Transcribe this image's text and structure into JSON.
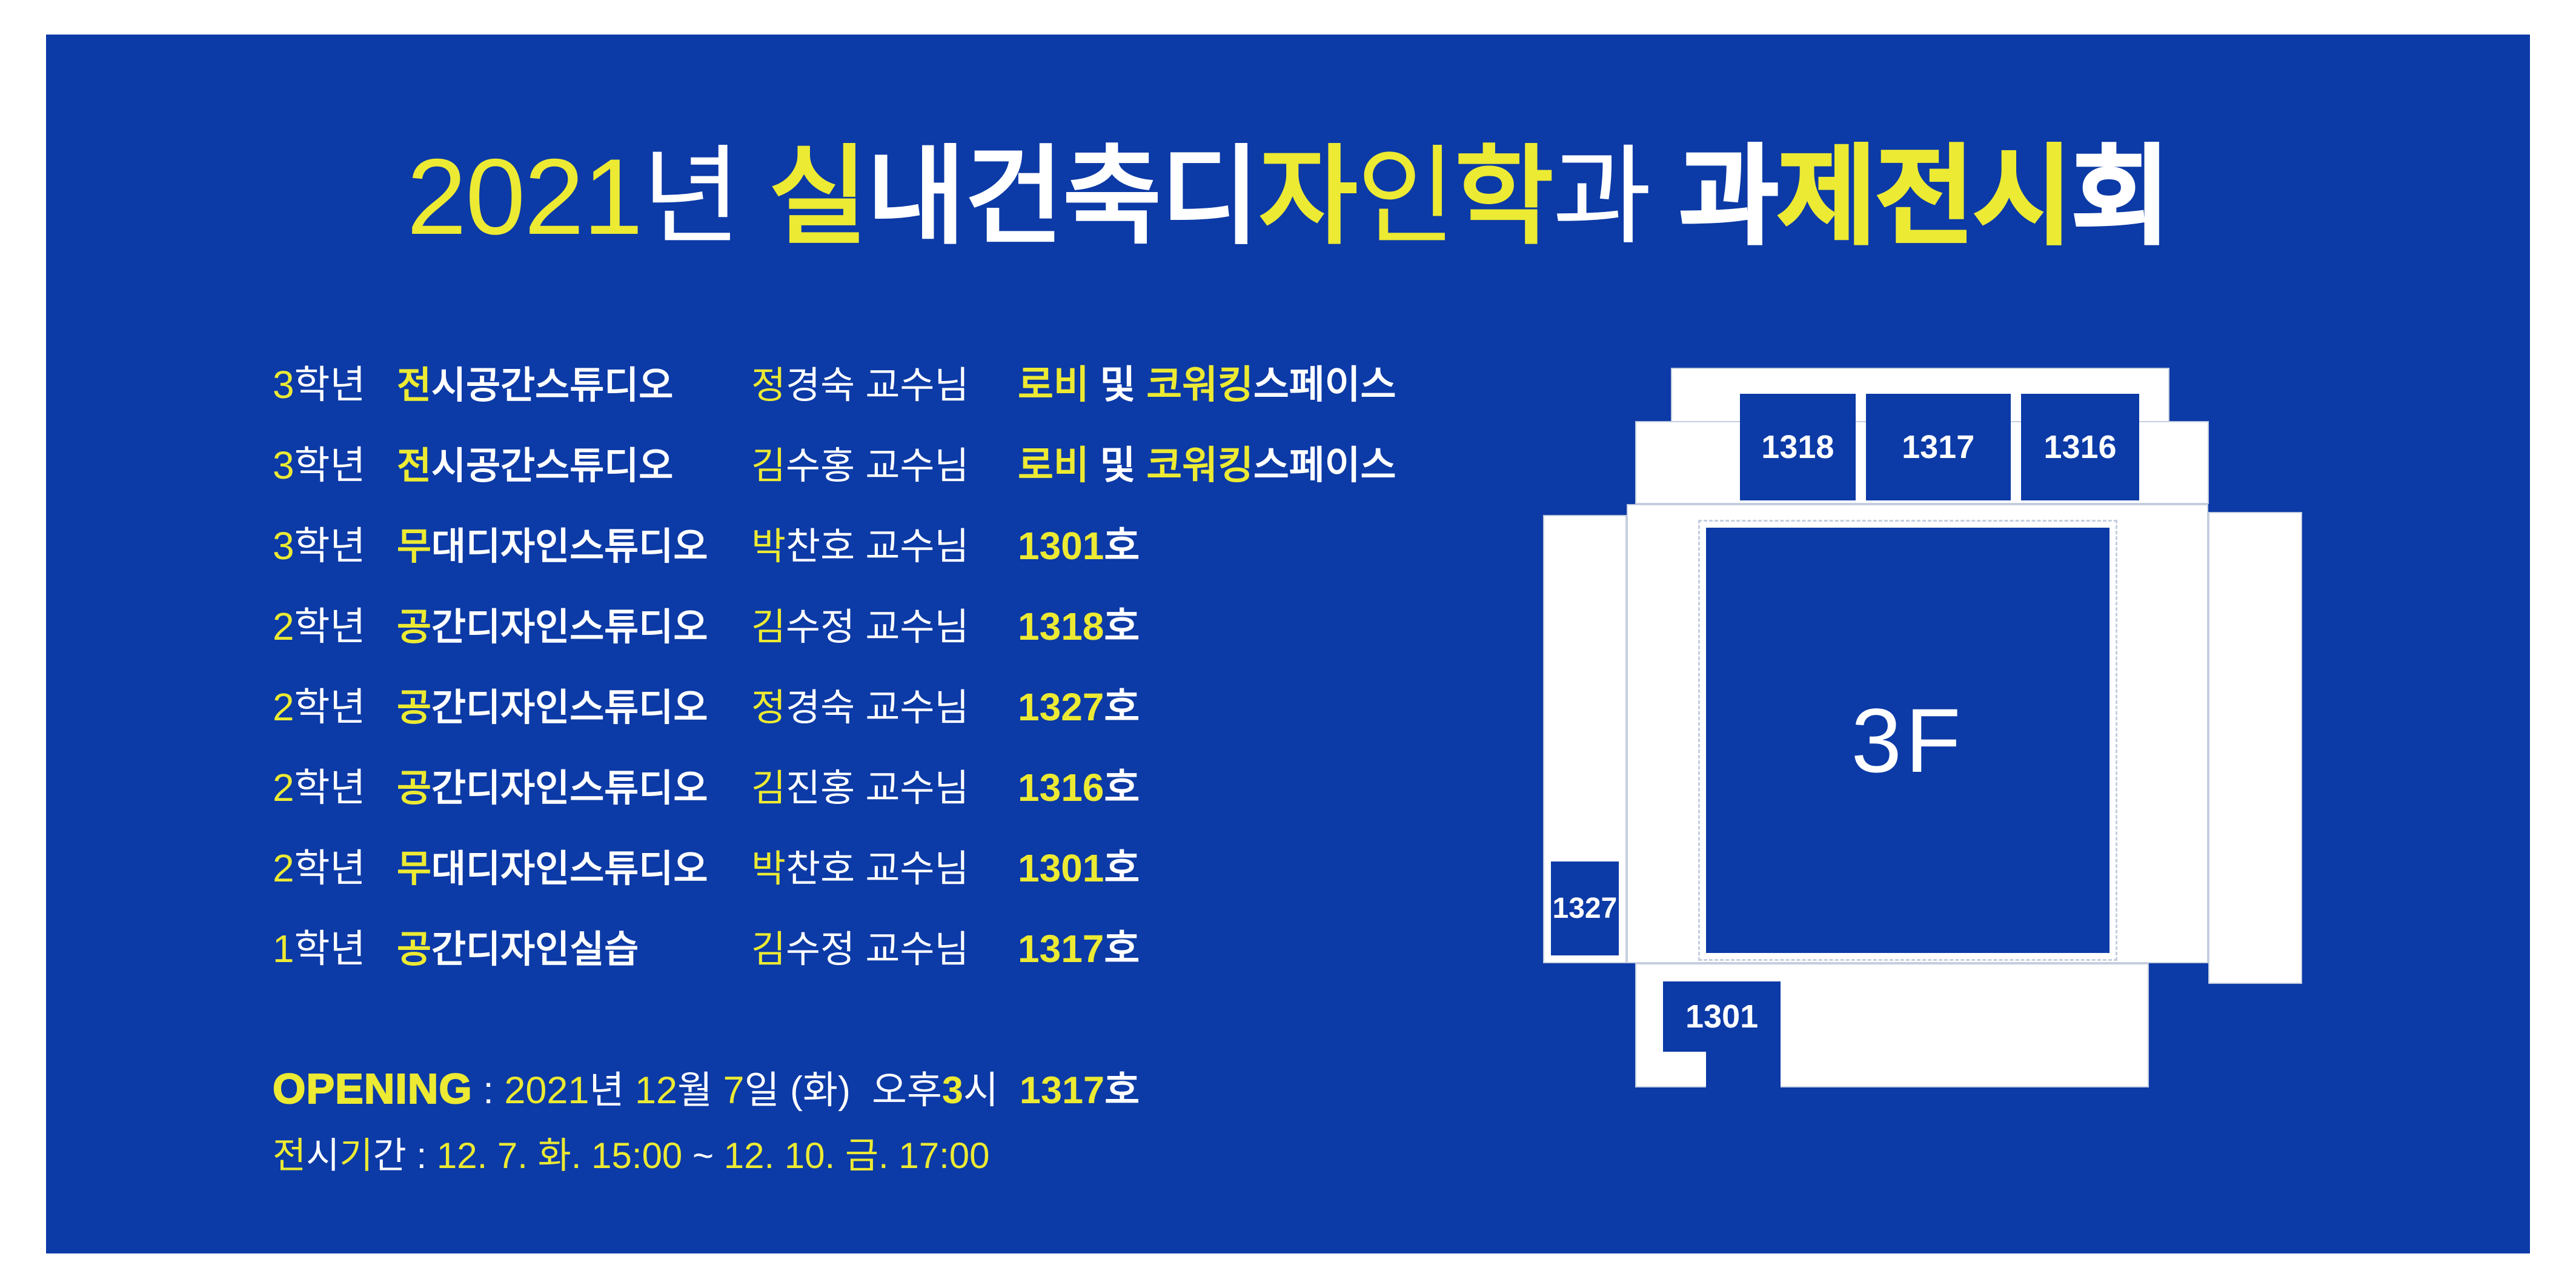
{
  "colors": {
    "background": "#0C3AA6",
    "accent": "#ECEA33",
    "white": "#FFFFFF",
    "plan_line": "#C5CEDF"
  },
  "title": {
    "segments": [
      {
        "t": "2021",
        "c": "y",
        "w": "l"
      },
      {
        "t": "년",
        "c": "w",
        "w": "l"
      },
      {
        "t": " ",
        "c": "w",
        "w": "l"
      },
      {
        "t": "실",
        "c": "y",
        "w": "b"
      },
      {
        "t": "내",
        "c": "w",
        "w": "b"
      },
      {
        "t": "건",
        "c": "w",
        "w": "b"
      },
      {
        "t": "축",
        "c": "w",
        "w": "b"
      },
      {
        "t": "디",
        "c": "w",
        "w": "b"
      },
      {
        "t": "자",
        "c": "y",
        "w": "b"
      },
      {
        "t": "인",
        "c": "y",
        "w": "l"
      },
      {
        "t": "학",
        "c": "y",
        "w": "b"
      },
      {
        "t": "과",
        "c": "w",
        "w": "l"
      },
      {
        "t": " ",
        "c": "w",
        "w": "l"
      },
      {
        "t": "과",
        "c": "w",
        "w": "h"
      },
      {
        "t": "제",
        "c": "y",
        "w": "h"
      },
      {
        "t": "전",
        "c": "y",
        "w": "h"
      },
      {
        "t": "시",
        "c": "y",
        "w": "h"
      },
      {
        "t": "회",
        "c": "w",
        "w": "h"
      }
    ]
  },
  "schedule": [
    {
      "grade": [
        {
          "t": "3",
          "c": "y",
          "w": "l"
        },
        {
          "t": "학년",
          "c": "w",
          "w": "l"
        }
      ],
      "studio": [
        {
          "t": "전",
          "c": "y",
          "w": "b"
        },
        {
          "t": "시공간스튜디오",
          "c": "w",
          "w": "b"
        }
      ],
      "professor": [
        {
          "t": "정",
          "c": "y",
          "w": "l"
        },
        {
          "t": "경숙 교수님",
          "c": "w",
          "w": "l"
        }
      ],
      "location": [
        {
          "t": "로비",
          "c": "y",
          "w": "b"
        },
        {
          "t": " 및 ",
          "c": "w",
          "w": "b"
        },
        {
          "t": "코워킹",
          "c": "y",
          "w": "b"
        },
        {
          "t": "스페이스",
          "c": "w",
          "w": "b"
        }
      ]
    },
    {
      "grade": [
        {
          "t": "3",
          "c": "y",
          "w": "l"
        },
        {
          "t": "학년",
          "c": "w",
          "w": "l"
        }
      ],
      "studio": [
        {
          "t": "전",
          "c": "y",
          "w": "b"
        },
        {
          "t": "시공간스튜디오",
          "c": "w",
          "w": "b"
        }
      ],
      "professor": [
        {
          "t": "김",
          "c": "y",
          "w": "l"
        },
        {
          "t": "수홍 교수님",
          "c": "w",
          "w": "l"
        }
      ],
      "location": [
        {
          "t": "로비",
          "c": "y",
          "w": "b"
        },
        {
          "t": " 및 ",
          "c": "w",
          "w": "b"
        },
        {
          "t": "코워킹",
          "c": "y",
          "w": "b"
        },
        {
          "t": "스페이스",
          "c": "w",
          "w": "b"
        }
      ]
    },
    {
      "grade": [
        {
          "t": "3",
          "c": "y",
          "w": "l"
        },
        {
          "t": "학년",
          "c": "w",
          "w": "l"
        }
      ],
      "studio": [
        {
          "t": "무",
          "c": "y",
          "w": "b"
        },
        {
          "t": "대디자인스튜디오",
          "c": "w",
          "w": "b"
        }
      ],
      "professor": [
        {
          "t": "박",
          "c": "y",
          "w": "l"
        },
        {
          "t": "찬호 교수님",
          "c": "w",
          "w": "l"
        }
      ],
      "location": [
        {
          "t": "1301",
          "c": "y",
          "w": "b"
        },
        {
          "t": "호",
          "c": "w",
          "w": "b"
        }
      ]
    },
    {
      "grade": [
        {
          "t": "2",
          "c": "y",
          "w": "l"
        },
        {
          "t": "학년",
          "c": "w",
          "w": "l"
        }
      ],
      "studio": [
        {
          "t": "공",
          "c": "y",
          "w": "b"
        },
        {
          "t": "간디자인스튜디오",
          "c": "w",
          "w": "b"
        }
      ],
      "professor": [
        {
          "t": "김",
          "c": "y",
          "w": "l"
        },
        {
          "t": "수정 교수님",
          "c": "w",
          "w": "l"
        }
      ],
      "location": [
        {
          "t": "1318",
          "c": "y",
          "w": "b"
        },
        {
          "t": "호",
          "c": "w",
          "w": "b"
        }
      ]
    },
    {
      "grade": [
        {
          "t": "2",
          "c": "y",
          "w": "l"
        },
        {
          "t": "학년",
          "c": "w",
          "w": "l"
        }
      ],
      "studio": [
        {
          "t": "공",
          "c": "y",
          "w": "b"
        },
        {
          "t": "간디자인스튜디오",
          "c": "w",
          "w": "b"
        }
      ],
      "professor": [
        {
          "t": "정",
          "c": "y",
          "w": "l"
        },
        {
          "t": "경숙 교수님",
          "c": "w",
          "w": "l"
        }
      ],
      "location": [
        {
          "t": "1327",
          "c": "y",
          "w": "b"
        },
        {
          "t": "호",
          "c": "w",
          "w": "b"
        }
      ]
    },
    {
      "grade": [
        {
          "t": "2",
          "c": "y",
          "w": "l"
        },
        {
          "t": "학년",
          "c": "w",
          "w": "l"
        }
      ],
      "studio": [
        {
          "t": "공",
          "c": "y",
          "w": "b"
        },
        {
          "t": "간디자인스튜디오",
          "c": "w",
          "w": "b"
        }
      ],
      "professor": [
        {
          "t": "김",
          "c": "y",
          "w": "l"
        },
        {
          "t": "진홍 교수님",
          "c": "w",
          "w": "l"
        }
      ],
      "location": [
        {
          "t": "1316",
          "c": "y",
          "w": "b"
        },
        {
          "t": "호",
          "c": "w",
          "w": "b"
        }
      ]
    },
    {
      "grade": [
        {
          "t": "2",
          "c": "y",
          "w": "l"
        },
        {
          "t": "학년",
          "c": "w",
          "w": "l"
        }
      ],
      "studio": [
        {
          "t": "무",
          "c": "y",
          "w": "b"
        },
        {
          "t": "대디자인스튜디오",
          "c": "w",
          "w": "b"
        }
      ],
      "professor": [
        {
          "t": "박",
          "c": "y",
          "w": "l"
        },
        {
          "t": "찬호 교수님",
          "c": "w",
          "w": "l"
        }
      ],
      "location": [
        {
          "t": "1301",
          "c": "y",
          "w": "b"
        },
        {
          "t": "호",
          "c": "w",
          "w": "b"
        }
      ]
    },
    {
      "grade": [
        {
          "t": "1",
          "c": "y",
          "w": "l"
        },
        {
          "t": "학년",
          "c": "w",
          "w": "l"
        }
      ],
      "studio": [
        {
          "t": "공",
          "c": "y",
          "w": "b"
        },
        {
          "t": "간디자인실습",
          "c": "w",
          "w": "b"
        }
      ],
      "professor": [
        {
          "t": "김",
          "c": "y",
          "w": "l"
        },
        {
          "t": "수정 교수님",
          "c": "w",
          "w": "l"
        }
      ],
      "location": [
        {
          "t": "1317",
          "c": "y",
          "w": "b"
        },
        {
          "t": "호",
          "c": "w",
          "w": "b"
        }
      ]
    }
  ],
  "opening": {
    "segments": [
      {
        "t": "OPENING",
        "c": "y",
        "w": "h"
      },
      {
        "t": " : ",
        "c": "w",
        "w": "l"
      },
      {
        "t": "2021",
        "c": "y",
        "w": "l"
      },
      {
        "t": "년 ",
        "c": "w",
        "w": "l"
      },
      {
        "t": "12",
        "c": "y",
        "w": "l"
      },
      {
        "t": "월 ",
        "c": "w",
        "w": "l"
      },
      {
        "t": "7",
        "c": "y",
        "w": "l"
      },
      {
        "t": "일 (화)",
        "c": "w",
        "w": "l"
      },
      {
        "t": "  오후",
        "c": "w",
        "w": "l"
      },
      {
        "t": "3",
        "c": "y",
        "w": "b"
      },
      {
        "t": "시  ",
        "c": "w",
        "w": "l"
      },
      {
        "t": "1317",
        "c": "y",
        "w": "b"
      },
      {
        "t": "호",
        "c": "w",
        "w": "b"
      }
    ]
  },
  "period": {
    "segments": [
      {
        "t": "전",
        "c": "y",
        "w": "l"
      },
      {
        "t": "시",
        "c": "w",
        "w": "l"
      },
      {
        "t": "기",
        "c": "y",
        "w": "l"
      },
      {
        "t": "간",
        "c": "w",
        "w": "l"
      },
      {
        "t": " : ",
        "c": "w",
        "w": "l"
      },
      {
        "t": "12. 7. 화. 15:00 ",
        "c": "y",
        "w": "l"
      },
      {
        "t": "~",
        "c": "w",
        "w": "l"
      },
      {
        "t": " 12. 10. 금. 17:00",
        "c": "y",
        "w": "l"
      }
    ]
  },
  "floorplan": {
    "floor_label": "3F",
    "rooms": [
      {
        "id": "1318"
      },
      {
        "id": "1317"
      },
      {
        "id": "1316"
      },
      {
        "id": "1327"
      },
      {
        "id": "1301"
      }
    ]
  }
}
